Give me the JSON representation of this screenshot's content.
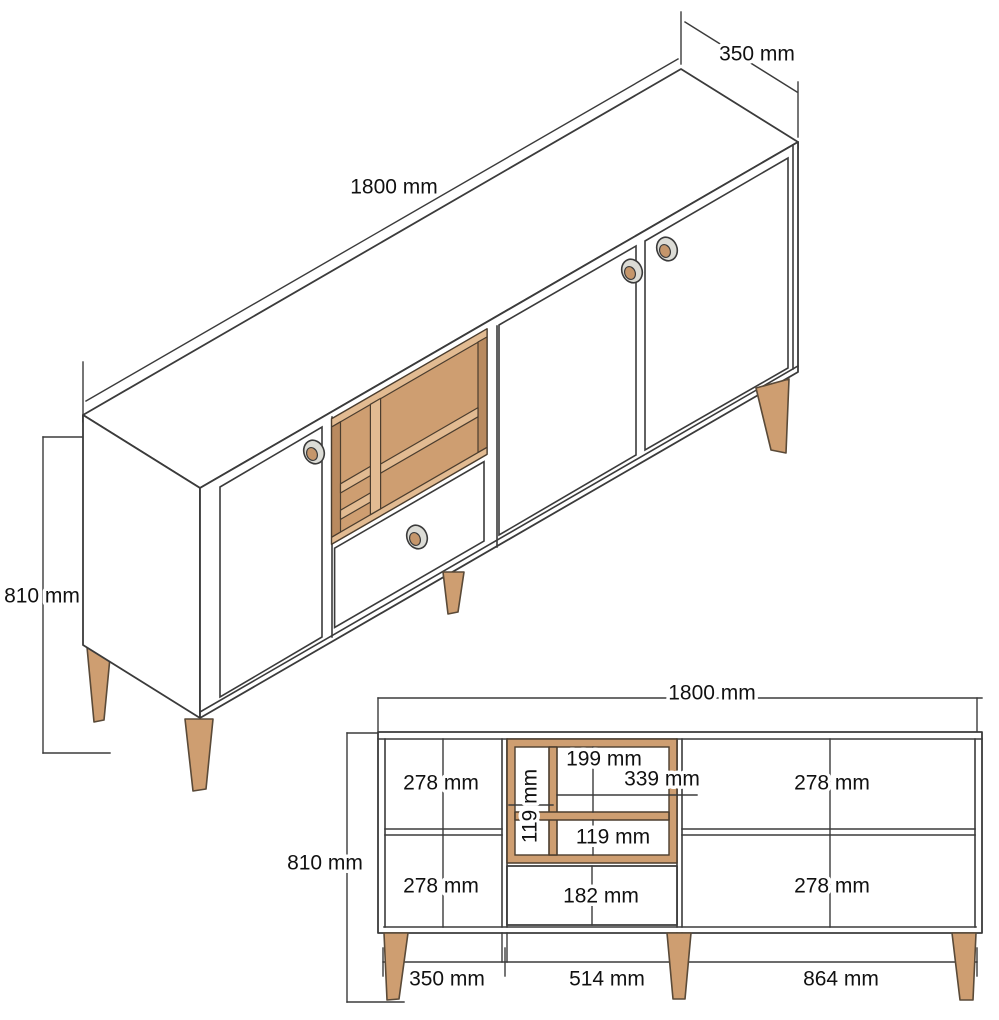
{
  "drawing": {
    "subject": "sideboard-technical-drawing",
    "colors": {
      "wood": "#CE9E71",
      "wood_light": "#E2BB92",
      "wood_dark": "#B98A5F",
      "line": "#3b3b3b",
      "text": "#111111"
    },
    "iso": {
      "width": "1800 mm",
      "depth": "350 mm",
      "height": "810 mm"
    },
    "front": {
      "width": "1800 mm",
      "height": "810 mm",
      "left_top": "278 mm",
      "left_bottom": "278 mm",
      "right_top": "278 mm",
      "right_bottom": "278 mm",
      "shelf_top_cell": "199 mm",
      "shelf_right_width": "339 mm",
      "shelf_left_col": "119 mm",
      "shelf_bottom_cell": "119 mm",
      "drawer_front": "182 mm",
      "section_left": "350 mm",
      "section_middle": "514 mm",
      "section_right": "864 mm"
    }
  }
}
